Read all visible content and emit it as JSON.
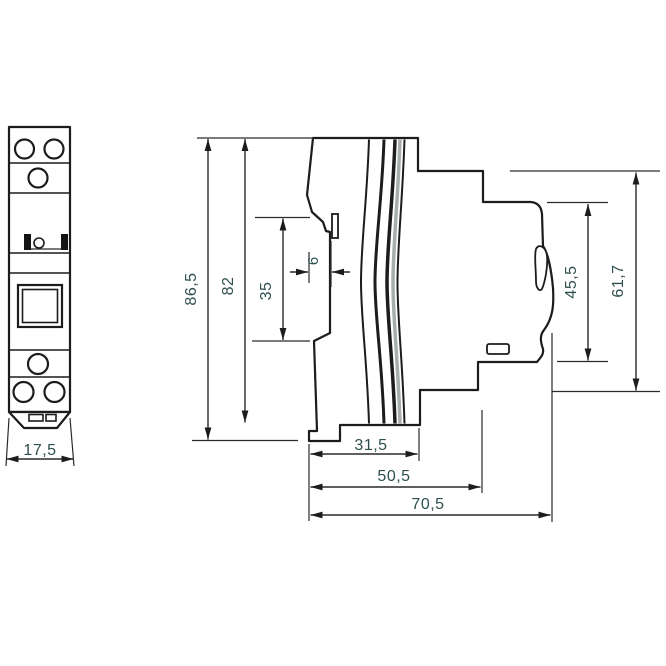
{
  "drawing": {
    "type": "technical-dimension-drawing",
    "subject": "din-rail-modular-device-front-and-side-view",
    "colors": {
      "line": "#1c1c1c",
      "dim_text": "#2f4f4f",
      "seam_gray": "#a8adad",
      "background": "#ffffff"
    },
    "dims": {
      "front_width": "17,5",
      "total_height": "86,5",
      "body_height": "82",
      "din_rail_seat": "35",
      "hook_tab": "6",
      "front_section_height": "45,5",
      "front_total_height": "61,7",
      "depth_rear": "31,5",
      "depth_mid": "50,5",
      "depth_total": "70,5"
    }
  }
}
